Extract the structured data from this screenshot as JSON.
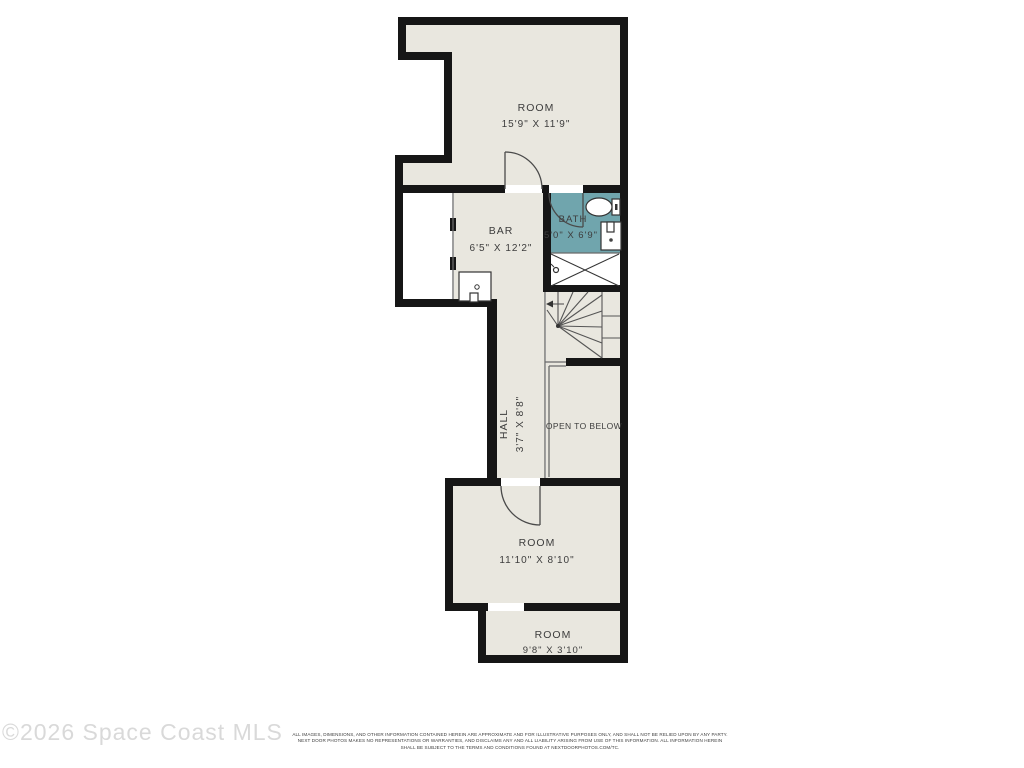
{
  "plan": {
    "rooms": [
      {
        "name": "room-top",
        "label": "ROOM",
        "dims": "15'9\" X 11'9\""
      },
      {
        "name": "bar",
        "label": "BAR",
        "dims": "6'5\" X 12'2\""
      },
      {
        "name": "bath",
        "label": "BATH",
        "dims": "5'0\" X 6'9\""
      },
      {
        "name": "hall",
        "label": "HALL",
        "dims": "3'7\" X 8'8\""
      },
      {
        "name": "open-to-below",
        "label": "OPEN TO BELOW",
        "dims": ""
      },
      {
        "name": "room-middle",
        "label": "ROOM",
        "dims": "11'10\" X 8'10\""
      },
      {
        "name": "room-bottom",
        "label": "ROOM",
        "dims": "9'8\" X 3'10\""
      }
    ],
    "fixtures": [
      "stairs",
      "toilet",
      "bath-sink",
      "shower",
      "bar-sink",
      "doors"
    ],
    "colors": {
      "floor": "#e9e7df",
      "wall": "#161616",
      "bath_floor": "#70a5ad",
      "line": "#5a5a5a",
      "label_text": "#3d3d3d"
    }
  },
  "footer": {
    "watermark": "©2026 Space Coast MLS",
    "disclaimer": [
      "ALL IMAGES, DIMENSIONS, AND OTHER INFORMATION CONTAINED HEREIN ARE APPROXIMATE AND FOR ILLUSTRATIVE PURPOSES ONLY, AND SHALL NOT BE RELIED UPON BY ANY PARTY.",
      "NEXT DOOR PHOTOS MAKES NO REPRESENTATIONS OR WARRANTIES, AND DISCLAIMS ANY AND ALL LIABILITY ARISING FROM USE OF THIS INFORMATION. ALL INFORMATION HEREIN",
      "SHALL BE SUBJECT TO THE TERMS AND CONDITIONS FOUND AT NEXTDOORPHOTOS.COM/TC."
    ]
  }
}
